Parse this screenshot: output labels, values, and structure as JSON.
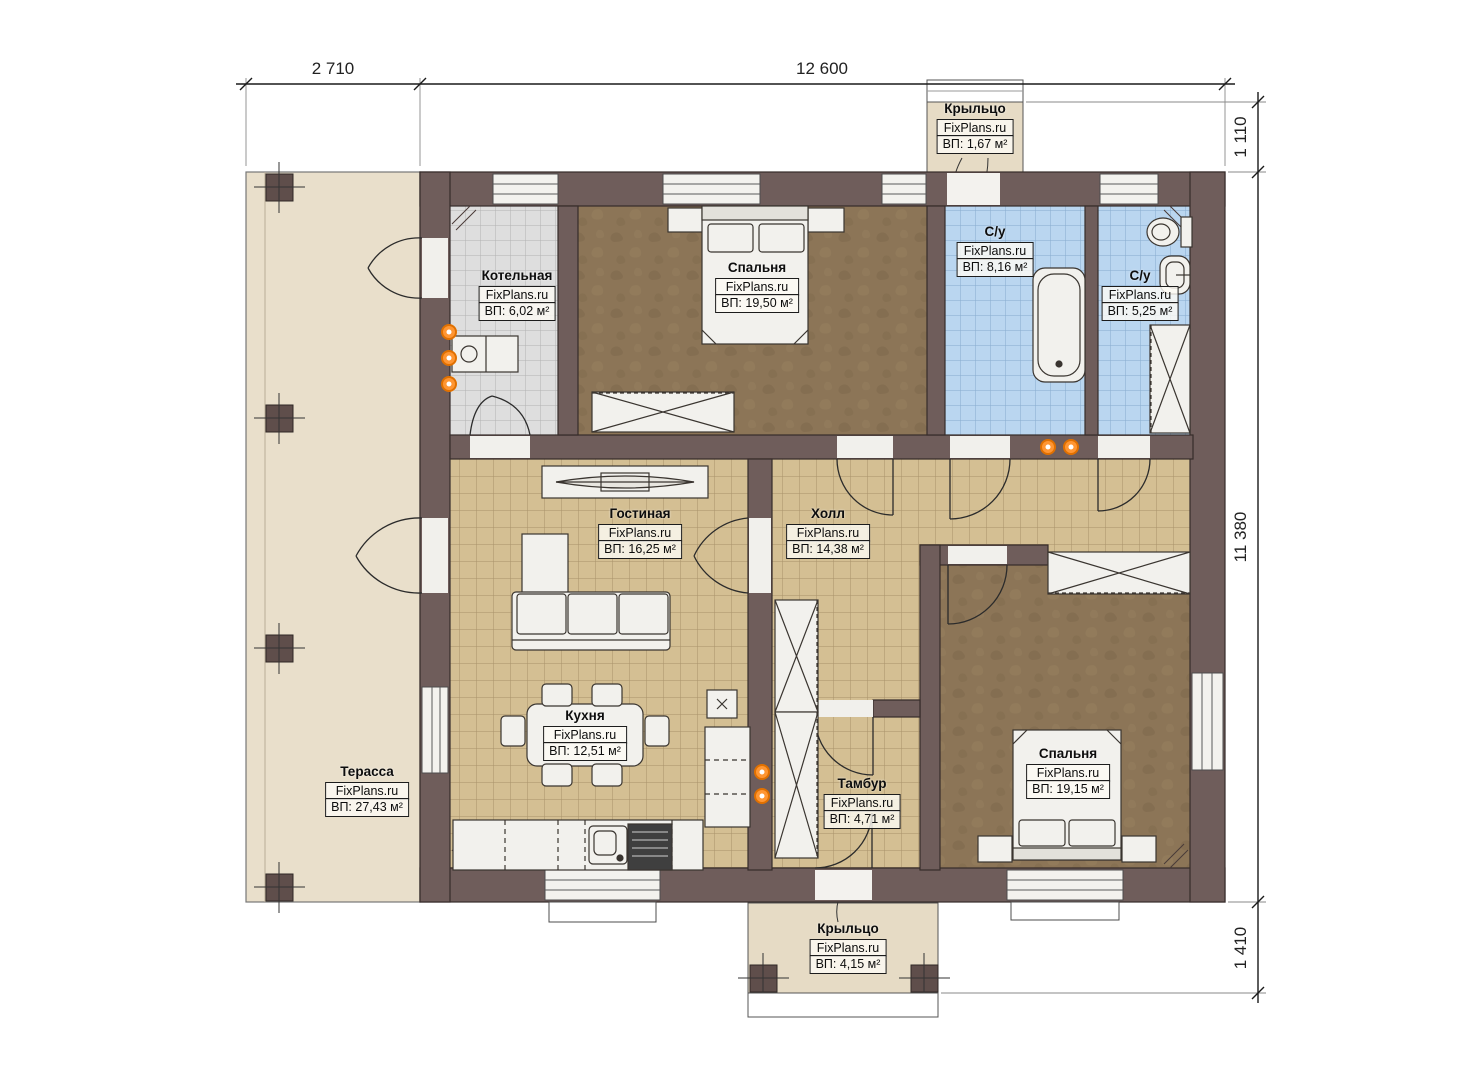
{
  "brand": "FixPlans.ru",
  "plan": {
    "rooms": [
      {
        "key": "boiler",
        "name": "Котельная",
        "area": "ВП: 6,02 м²"
      },
      {
        "key": "bedroom-top",
        "name": "Спальня",
        "area": "ВП: 19,50 м²"
      },
      {
        "key": "bathroom-large",
        "name": "С/у",
        "area": "ВП: 8,16 м²"
      },
      {
        "key": "bathroom-small",
        "name": "С/у",
        "area": "ВП: 5,25 м²"
      },
      {
        "key": "living-room",
        "name": "Гостиная",
        "area": "ВП: 16,25 м²"
      },
      {
        "key": "hall",
        "name": "Холл",
        "area": "ВП: 14,38 м²"
      },
      {
        "key": "kitchen",
        "name": "Кухня",
        "area": "ВП: 12,51 м²"
      },
      {
        "key": "vestibule",
        "name": "Тамбур",
        "area": "ВП: 4,71 м²"
      },
      {
        "key": "bedroom-bottom",
        "name": "Спальня",
        "area": "ВП: 19,15 м²"
      },
      {
        "key": "terrace",
        "name": "Терасса",
        "area": "ВП: 27,43 м²"
      },
      {
        "key": "porch-top",
        "name": "Крыльцо",
        "area": "ВП: 1,67 м²"
      },
      {
        "key": "porch-bottom",
        "name": "Крыльцо",
        "area": "ВП: 4,15 м²"
      }
    ],
    "dimensions": {
      "top": [
        "2 710",
        "12 600"
      ],
      "right": [
        "1 110",
        "11 380",
        "1 410"
      ]
    },
    "colors": {
      "wall": "#6f5d5b",
      "tile_beige": "#d4bf93",
      "tile_blue": "#bad6f0",
      "tile_gray": "#dedede",
      "floor_brown": "#8c7557",
      "terrace": "#e9dfcb",
      "porch": "#e6dbc5",
      "radiator": "#f08200"
    }
  }
}
